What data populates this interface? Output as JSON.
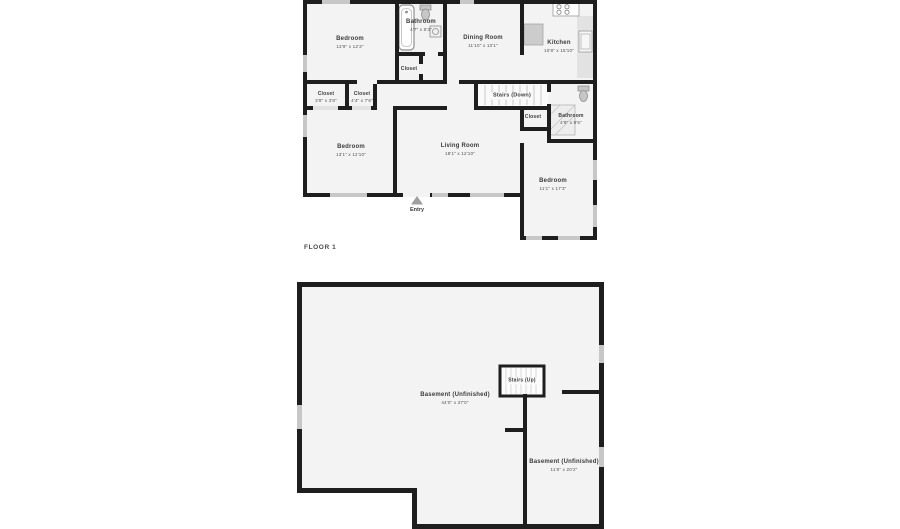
{
  "title": "Floor plan",
  "colors": {
    "wall": "#1e1e1e",
    "room_fill": "#f3f3f3",
    "window_mark": "#c7c7c7",
    "door_mark": "#e3e3e3",
    "stair_hatch": "#c9c9c9",
    "fixture_stroke": "#8f8f8f",
    "label_text": "#3b3b3b"
  },
  "floor1": {
    "floor_label": "FLOOR 1",
    "entry_label": "Entry",
    "rooms": [
      {
        "id": "bedroom-1",
        "name": "Bedroom",
        "dims": "13'9\" x 12'3\""
      },
      {
        "id": "bathroom-1",
        "name": "Bathroom",
        "dims": "4'7\" x 8'3\""
      },
      {
        "id": "dining-room",
        "name": "Dining Room",
        "dims": "11'10\" x 13'1\""
      },
      {
        "id": "kitchen",
        "name": "Kitchen",
        "dims": "10'8\" x 15'10\""
      },
      {
        "id": "closet-1",
        "name": "Closet",
        "dims": "3'8\" x 3'8\""
      },
      {
        "id": "closet-2",
        "name": "Closet",
        "dims": "4'4\" x 7'6\""
      },
      {
        "id": "closet-3",
        "name": "Closet",
        "dims": ""
      },
      {
        "id": "stairs-down",
        "name": "Stairs (Down)",
        "dims": ""
      },
      {
        "id": "closet-4",
        "name": "Closet",
        "dims": ""
      },
      {
        "id": "bathroom-2",
        "name": "Bathroom",
        "dims": "4'9\" x 8'5\""
      },
      {
        "id": "bedroom-2",
        "name": "Bedroom",
        "dims": "13'1\" x 12'10\""
      },
      {
        "id": "living-room",
        "name": "Living Room",
        "dims": "18'1\" x 12'10\""
      },
      {
        "id": "bedroom-3",
        "name": "Bedroom",
        "dims": "11'1\" x 17'3\""
      }
    ]
  },
  "basement": {
    "rooms": [
      {
        "id": "stairs-up",
        "name": "Stairs (Up)",
        "dims": ""
      },
      {
        "id": "basement-main",
        "name": "Basement (Unfinished)",
        "dims": "44'0\" x 37'0\""
      },
      {
        "id": "basement-second",
        "name": "Basement (Unfinished)",
        "dims": "11'6\" x 20'2\""
      }
    ]
  }
}
